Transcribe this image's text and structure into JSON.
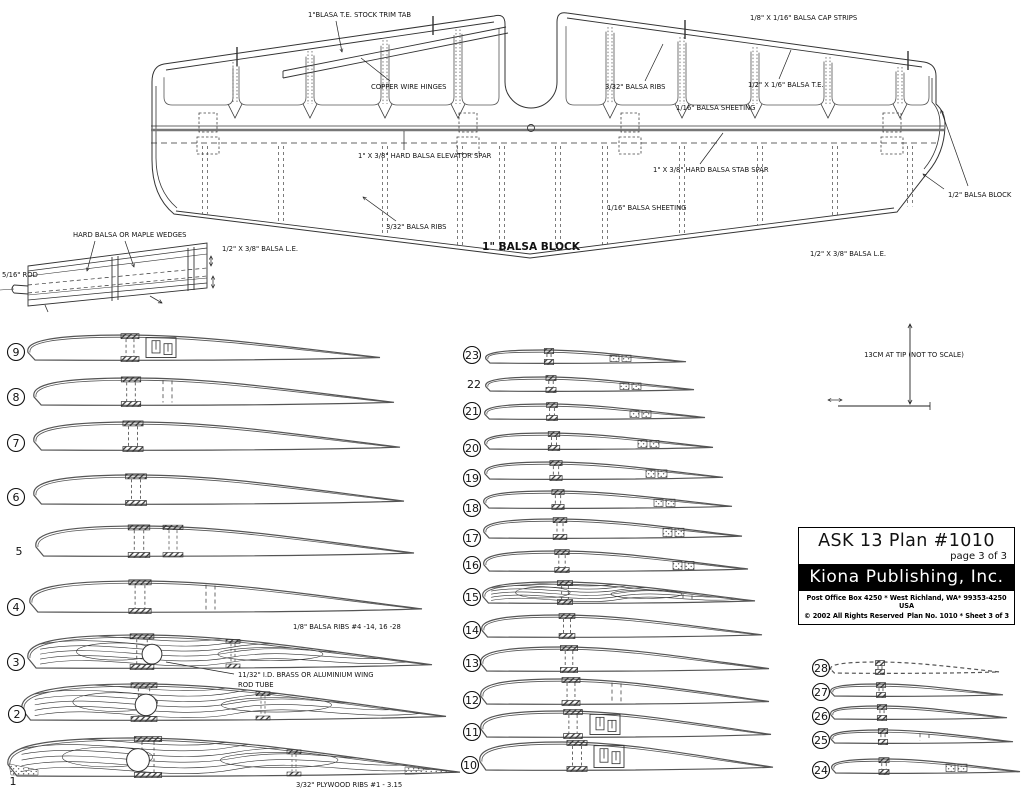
{
  "colors": {
    "ink": "#222222",
    "gray_spar": "#777777",
    "paper": "#ffffff"
  },
  "title_block": {
    "plan_title": "ASK  13 Plan #1010",
    "page_note": "page 3 of 3",
    "publisher": "Kiona Publishing, Inc.",
    "address": "Post Office Box 4250 * West Richland, WA* 99353-4250 USA",
    "copyright": "© 2002 All Rights Reserved",
    "plan_no": "Plan No. 1010 * Sheet 3 of 3"
  },
  "stab_plan": {
    "labels": [
      {
        "id": "trim-tab",
        "text": "1\"BLASA T.E. STOCK TRIM TAB",
        "x": 308,
        "y": 17,
        "leader": [
          336,
          21,
          342,
          52
        ],
        "arrow": true
      },
      {
        "id": "copper-hinges",
        "text": "COPPER WIRE HINGES",
        "x": 371,
        "y": 89,
        "leader": [
          390,
          81,
          361,
          58
        ],
        "arrow": false
      },
      {
        "id": "balsa-ribs-top",
        "text": "3/32\" BALSA RIBS",
        "x": 605,
        "y": 89,
        "leader": [
          645,
          81,
          663,
          44
        ],
        "arrow": false
      },
      {
        "id": "sheeting-top",
        "text": "1/16\" BALSA SHEETING",
        "x": 676,
        "y": 110
      },
      {
        "id": "cap-strips",
        "text": "1/8\" X 1/16\" BALSA CAP STRIPS",
        "x": 750,
        "y": 20
      },
      {
        "id": "balsa-te",
        "text": "1/2\" X 1/6\" BALSA T.E.",
        "x": 748,
        "y": 87,
        "leader": [
          779,
          79,
          791,
          50
        ],
        "arrow": false
      },
      {
        "id": "elevator-spar",
        "text": "1\" X 3/8\" HARD BALSA ELEVATOR SPAR",
        "x": 358,
        "y": 158,
        "leader": [
          404,
          150,
          404,
          131
        ],
        "arrow": false
      },
      {
        "id": "stab-spar",
        "text": "1\" X 3/8\" HARD BALSA STAB SPAR",
        "x": 653,
        "y": 172,
        "leader": [
          700,
          164,
          723,
          133
        ],
        "arrow": false
      },
      {
        "id": "sheeting-mid",
        "text": "1/16\" BALSA SHEETING",
        "x": 607,
        "y": 210
      },
      {
        "id": "balsa-ribs-mid",
        "text": "3/32\" BALSA RIBS",
        "x": 386,
        "y": 229,
        "leader": [
          396,
          221,
          363,
          197
        ],
        "arrow": true
      },
      {
        "id": "balsa-block-1in",
        "text": "1\" BALSA BLOCK",
        "x": 531,
        "y": 250,
        "size": 10.5,
        "anchor": "middle",
        "bold": true
      },
      {
        "id": "balsa-block-half",
        "text": "1/2\" BALSA BLOCK",
        "x": 948,
        "y": 197,
        "leader": [
          944,
          189,
          923,
          174
        ],
        "arrow": true,
        "leader2": [
          968,
          186,
          941,
          110
        ]
      },
      {
        "id": "balsa-le-left",
        "text": "1/2\" X 3/8\" BALSA L.E.",
        "x": 222,
        "y": 251
      },
      {
        "id": "balsa-le-right",
        "text": "1/2\" X 3/8\" BALSA L.E.",
        "x": 810,
        "y": 256
      }
    ]
  },
  "wedge_detail": {
    "labels": [
      {
        "id": "wedges",
        "text": "HARD BALSA OR MAPLE WEDGES",
        "x": 73,
        "y": 237,
        "leader": [
          95,
          241,
          87,
          271
        ],
        "arrow": true,
        "leader2": [
          125,
          241,
          134,
          267
        ]
      },
      {
        "id": "rod",
        "text": "5/16\" ROD",
        "x": 2,
        "y": 277
      }
    ]
  },
  "dimension_note": {
    "text": "13CM AT TIP (NOT TO SCALE)",
    "x": 914,
    "y": 357
  },
  "rib_labels": [
    {
      "id": "balsa-ribs-note",
      "text": "1/8\" BALSA RIBS #4 -14, 16 -28",
      "x": 293,
      "y": 629
    },
    {
      "id": "wing-rod-tube-1",
      "text": "11/32\" I.D. BRASS OR ALUMINIUM WING",
      "x": 238,
      "y": 677,
      "leader": [
        234,
        674,
        166,
        662
      ]
    },
    {
      "id": "wing-rod-tube-2",
      "text": "ROD TUBE",
      "x": 238,
      "y": 687
    },
    {
      "id": "plywood-ribs-note",
      "text": "3/32\" PLYWOOD RIBS #1 - 3.15",
      "x": 296,
      "y": 787
    }
  ],
  "ribs": [
    {
      "n": "9",
      "circled": true,
      "nx": 16,
      "ny": 352,
      "x": 28,
      "y": 360,
      "len": 352,
      "th": 25,
      "spar": 130,
      "slot": 146
    },
    {
      "n": "8",
      "circled": true,
      "nx": 16,
      "ny": 397,
      "x": 34,
      "y": 405,
      "len": 360,
      "th": 27,
      "spar": 131,
      "rear": {
        "type": "dash",
        "x": 163
      }
    },
    {
      "n": "7",
      "circled": true,
      "nx": 16,
      "ny": 443,
      "x": 34,
      "y": 450,
      "len": 366,
      "th": 28,
      "spar": 133
    },
    {
      "n": "6",
      "circled": true,
      "nx": 16,
      "ny": 497,
      "x": 34,
      "y": 504,
      "len": 370,
      "th": 29,
      "spar": 136
    },
    {
      "n": "5",
      "circled": false,
      "nx": 19,
      "ny": 551,
      "x": 36,
      "y": 556,
      "len": 378,
      "th": 30,
      "spar": 139,
      "rear": {
        "type": "hatch",
        "x": 173
      }
    },
    {
      "n": "4",
      "circled": true,
      "nx": 16,
      "ny": 607,
      "x": 30,
      "y": 612,
      "len": 392,
      "th": 31,
      "spar": 140,
      "rear": {
        "type": "dash",
        "x": 206
      }
    },
    {
      "n": "3",
      "circled": true,
      "nx": 16,
      "ny": 662,
      "x": 28,
      "y": 668,
      "len": 404,
      "th": 33,
      "spar": 142,
      "grain": true,
      "hole": 152,
      "rear": {
        "type": "smallhatch",
        "x": 233
      }
    },
    {
      "n": "2",
      "circled": true,
      "nx": 17,
      "ny": 714,
      "x": 22,
      "y": 720,
      "len": 424,
      "th": 36,
      "spar": 144,
      "grain": true,
      "hole": 146,
      "rear": {
        "type": "smallhatch",
        "x": 263
      }
    },
    {
      "n": "1",
      "circled": false,
      "nx": 13,
      "ny": 781,
      "x": 8,
      "y": 776,
      "len": 452,
      "th": 38,
      "spar": 148,
      "grain": true,
      "hole": 138,
      "rear": {
        "type": "smallhatch",
        "x": 294
      },
      "tips": true
    },
    {
      "n": "23",
      "circled": true,
      "nx": 472,
      "ny": 355,
      "x": 486,
      "y": 363,
      "len": 200,
      "th": 13,
      "spar": 549,
      "rear": {
        "type": "stipple",
        "x": 610
      }
    },
    {
      "n": "22",
      "circled": false,
      "nx": 474,
      "ny": 384,
      "x": 486,
      "y": 391,
      "len": 208,
      "th": 14,
      "spar": 551,
      "rear": {
        "type": "stipple",
        "x": 620
      }
    },
    {
      "n": "21",
      "circled": true,
      "nx": 472,
      "ny": 411,
      "x": 485,
      "y": 419,
      "len": 220,
      "th": 15,
      "spar": 552,
      "rear": {
        "type": "stipple",
        "x": 630
      }
    },
    {
      "n": "20",
      "circled": true,
      "nx": 472,
      "ny": 448,
      "x": 485,
      "y": 449,
      "len": 228,
      "th": 16,
      "spar": 554,
      "rear": {
        "type": "stipple",
        "x": 638
      }
    },
    {
      "n": "19",
      "circled": true,
      "nx": 472,
      "ny": 478,
      "x": 485,
      "y": 479,
      "len": 238,
      "th": 17,
      "spar": 556,
      "rear": {
        "type": "stipple",
        "x": 646
      }
    },
    {
      "n": "18",
      "circled": true,
      "nx": 472,
      "ny": 508,
      "x": 484,
      "y": 508,
      "len": 248,
      "th": 17,
      "spar": 558,
      "rear": {
        "type": "stipple",
        "x": 654
      }
    },
    {
      "n": "17",
      "circled": true,
      "nx": 472,
      "ny": 538,
      "x": 484,
      "y": 538,
      "len": 258,
      "th": 19,
      "spar": 560,
      "rear": {
        "type": "stipple",
        "x": 663
      }
    },
    {
      "n": "16",
      "circled": true,
      "nx": 472,
      "ny": 565,
      "x": 484,
      "y": 571,
      "len": 264,
      "th": 20,
      "spar": 562,
      "rear": {
        "type": "stipple",
        "x": 673
      }
    },
    {
      "n": "15",
      "circled": true,
      "nx": 472,
      "ny": 597,
      "x": 483,
      "y": 603,
      "len": 272,
      "th": 21,
      "spar": 565,
      "grain": true,
      "rear": {
        "type": "dash",
        "x": 683
      }
    },
    {
      "n": "14",
      "circled": true,
      "nx": 472,
      "ny": 630,
      "x": 482,
      "y": 637,
      "len": 280,
      "th": 22,
      "spar": 567
    },
    {
      "n": "13",
      "circled": true,
      "nx": 472,
      "ny": 663,
      "x": 481,
      "y": 671,
      "len": 288,
      "th": 24,
      "spar": 569
    },
    {
      "n": "12",
      "circled": true,
      "nx": 472,
      "ny": 700,
      "x": 481,
      "y": 704,
      "len": 288,
      "th": 25,
      "spar": 571,
      "rear": {
        "type": "dash",
        "x": 612
      }
    },
    {
      "n": "11",
      "circled": true,
      "nx": 472,
      "ny": 732,
      "x": 481,
      "y": 737,
      "len": 290,
      "th": 26,
      "spar": 573,
      "slot": 590
    },
    {
      "n": "10",
      "circled": true,
      "nx": 470,
      "ny": 765,
      "x": 480,
      "y": 770,
      "len": 293,
      "th": 28,
      "spar": 577,
      "slot": 594
    },
    {
      "n": "28",
      "circled": true,
      "nx": 821,
      "ny": 668,
      "x": 831,
      "y": 673,
      "len": 168,
      "th": 11,
      "spar": 880,
      "dashed": true
    },
    {
      "n": "27",
      "circled": true,
      "nx": 821,
      "ny": 692,
      "x": 831,
      "y": 696,
      "len": 172,
      "th": 12,
      "spar": 881
    },
    {
      "n": "26",
      "circled": true,
      "nx": 821,
      "ny": 716,
      "x": 831,
      "y": 719,
      "len": 176,
      "th": 13,
      "spar": 882
    },
    {
      "n": "25",
      "circled": true,
      "nx": 821,
      "ny": 740,
      "x": 831,
      "y": 743,
      "len": 182,
      "th": 13,
      "spar": 883,
      "rear": {
        "type": "dash",
        "x": 920
      }
    },
    {
      "n": "24",
      "circled": true,
      "nx": 821,
      "ny": 770,
      "x": 832,
      "y": 773,
      "len": 188,
      "th": 14,
      "spar": 884,
      "rear": {
        "type": "stipple",
        "x": 946
      }
    }
  ]
}
